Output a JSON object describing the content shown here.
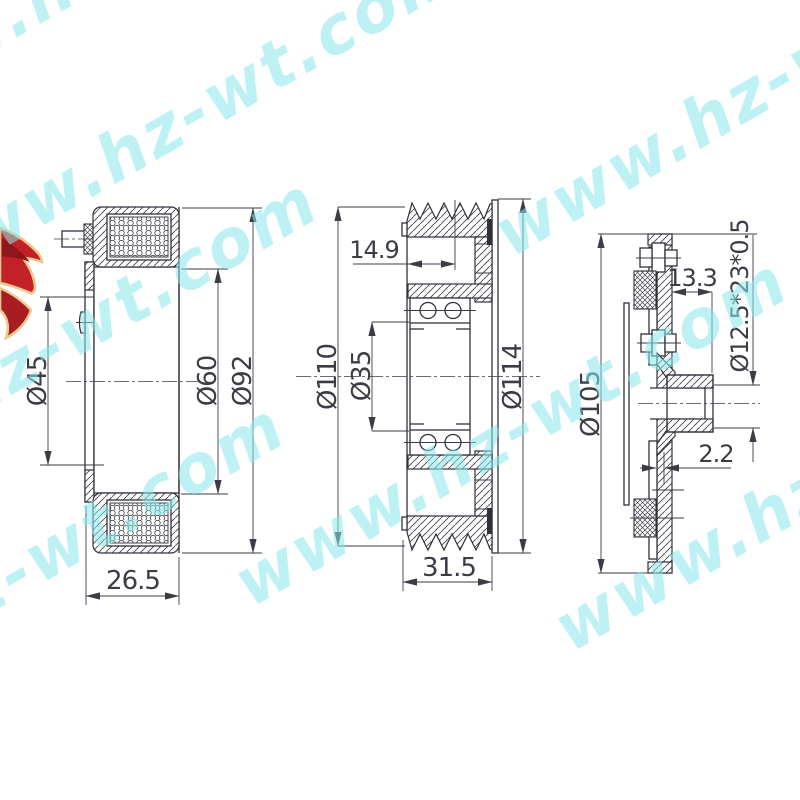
{
  "watermark": {
    "text": "www.hz-wt.com",
    "color": "#8ae7ea"
  },
  "logo": {
    "name": "red-ribbon-logo",
    "red": "#c32128",
    "trim": "#ecc98f"
  },
  "drawing": {
    "line_color": "#31313b",
    "views": {
      "coil": {
        "label": "field-coil-section",
        "dims": {
          "inner_dia": "Ø45",
          "mid_dia": "Ø60",
          "outer_dia": "Ø92",
          "depth": "26.5"
        }
      },
      "pulley": {
        "label": "pulley-bearing-section",
        "dims": {
          "groove_offset": "14.9",
          "groove_dia": "Ø110",
          "bore_dia": "Ø35",
          "flange_dia": "Ø114",
          "width": "31.5"
        }
      },
      "hub": {
        "label": "clutch-hub-section",
        "dims": {
          "outer_dia": "Ø105",
          "hub_depth": "13.3",
          "spline": "Ø12.5*23*0.5",
          "air_gap": "2.2"
        }
      }
    }
  }
}
